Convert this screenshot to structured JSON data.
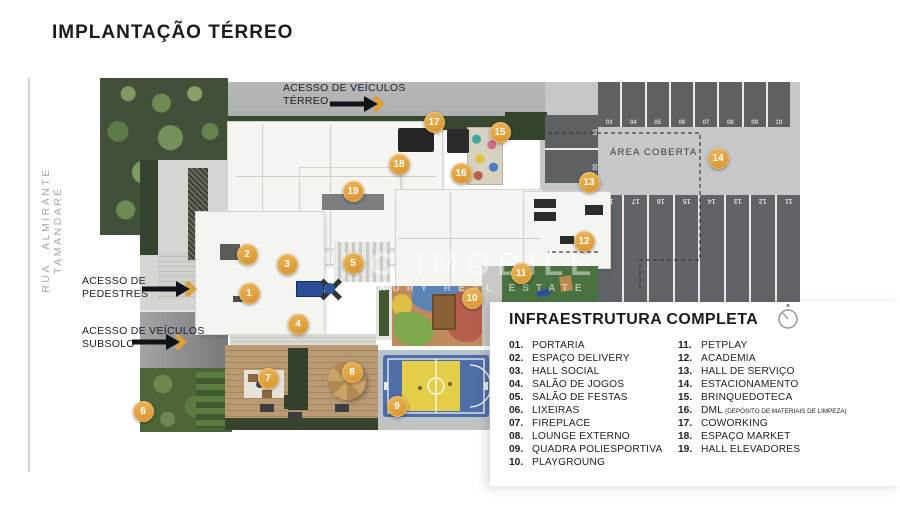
{
  "page": {
    "title": "IMPLANTAÇÃO TÉRREO"
  },
  "street": {
    "name": "RUA ALMIRANTE TAMANDARÉ"
  },
  "plan": {
    "labels": {
      "vehicle_access_ground_l1": "ACESSO DE VEÍCULOS",
      "vehicle_access_ground_l2": "TÉRREO",
      "pedestrian_access_l1": "ACESSO DE",
      "pedestrian_access_l2": "PEDESTRES",
      "vehicle_access_basement_l1": "ACESSO DE VEÍCULOS",
      "vehicle_access_basement_l2": "SUBSOLO",
      "covered_area": "ÁREA COBERTA"
    },
    "watermark": {
      "line1": "EC IMOBILE",
      "line2": "LUXURY REAL ESTATE"
    },
    "markers": [
      {
        "num": "1",
        "x": 249,
        "y": 293
      },
      {
        "num": "2",
        "x": 247,
        "y": 254
      },
      {
        "num": "3",
        "x": 287,
        "y": 264
      },
      {
        "num": "4",
        "x": 298,
        "y": 324
      },
      {
        "num": "5",
        "x": 353,
        "y": 263
      },
      {
        "num": "6",
        "x": 143,
        "y": 411
      },
      {
        "num": "7",
        "x": 268,
        "y": 378
      },
      {
        "num": "8",
        "x": 352,
        "y": 372
      },
      {
        "num": "9",
        "x": 397,
        "y": 406
      },
      {
        "num": "10",
        "x": 472,
        "y": 298
      },
      {
        "num": "11",
        "x": 521,
        "y": 273
      },
      {
        "num": "12",
        "x": 584,
        "y": 241
      },
      {
        "num": "13",
        "x": 589,
        "y": 182
      },
      {
        "num": "14",
        "x": 718,
        "y": 158
      },
      {
        "num": "15",
        "x": 500,
        "y": 132
      },
      {
        "num": "16",
        "x": 461,
        "y": 173
      },
      {
        "num": "17",
        "x": 434,
        "y": 122
      },
      {
        "num": "18",
        "x": 399,
        "y": 164
      },
      {
        "num": "19",
        "x": 353,
        "y": 191
      }
    ],
    "parking": {
      "side_stalls": [
        "01",
        "02"
      ],
      "top_row": [
        "03",
        "04",
        "05",
        "06",
        "07",
        "08",
        "09",
        "10"
      ],
      "bottom_row": [
        "18",
        "17",
        "16",
        "15",
        "14",
        "13",
        "12",
        "11"
      ]
    }
  },
  "legend": {
    "title": "INFRAESTRUTURA COMPLETA",
    "columns": [
      {
        "items": [
          {
            "num": "01.",
            "label": "PORTARIA"
          },
          {
            "num": "02.",
            "label": "ESPAÇO DELIVERY"
          },
          {
            "num": "03.",
            "label": "HALL SOCIAL"
          },
          {
            "num": "04.",
            "label": "SALÃO DE JOGOS"
          },
          {
            "num": "05.",
            "label": "SALÃO DE FESTAS"
          },
          {
            "num": "06.",
            "label": "LIXEIRAS"
          },
          {
            "num": "07.",
            "label": "FIREPLACE"
          },
          {
            "num": "08.",
            "label": "LOUNGE EXTERNO"
          },
          {
            "num": "09.",
            "label": "QUADRA POLIESPORTIVA"
          },
          {
            "num": "10.",
            "label": "PLAYGROUNG"
          }
        ]
      },
      {
        "items": [
          {
            "num": "11.",
            "label": "PETPLAY"
          },
          {
            "num": "12.",
            "label": "ACADEMIA"
          },
          {
            "num": "13.",
            "label": "HALL DE SERVIÇO"
          },
          {
            "num": "14.",
            "label": "ESTACIONAMENTO"
          },
          {
            "num": "15.",
            "label": "BRINQUEDOTECA"
          },
          {
            "num": "16.",
            "label": "DML",
            "note": "(DEPÓSITO DE MATERIAIS DE LIMPEZA)"
          },
          {
            "num": "17.",
            "label": "COWORKING"
          },
          {
            "num": "18.",
            "label": "ESPAÇO MARKET"
          },
          {
            "num": "19.",
            "label": "HALL ELEVADORES"
          }
        ]
      }
    ]
  },
  "colors": {
    "gold": "#E0A238",
    "ink": "#1B1B19",
    "street_gray": "#A8A8A8",
    "court_blue": "#4F6DA6",
    "court_yellow": "#E3CD49"
  }
}
